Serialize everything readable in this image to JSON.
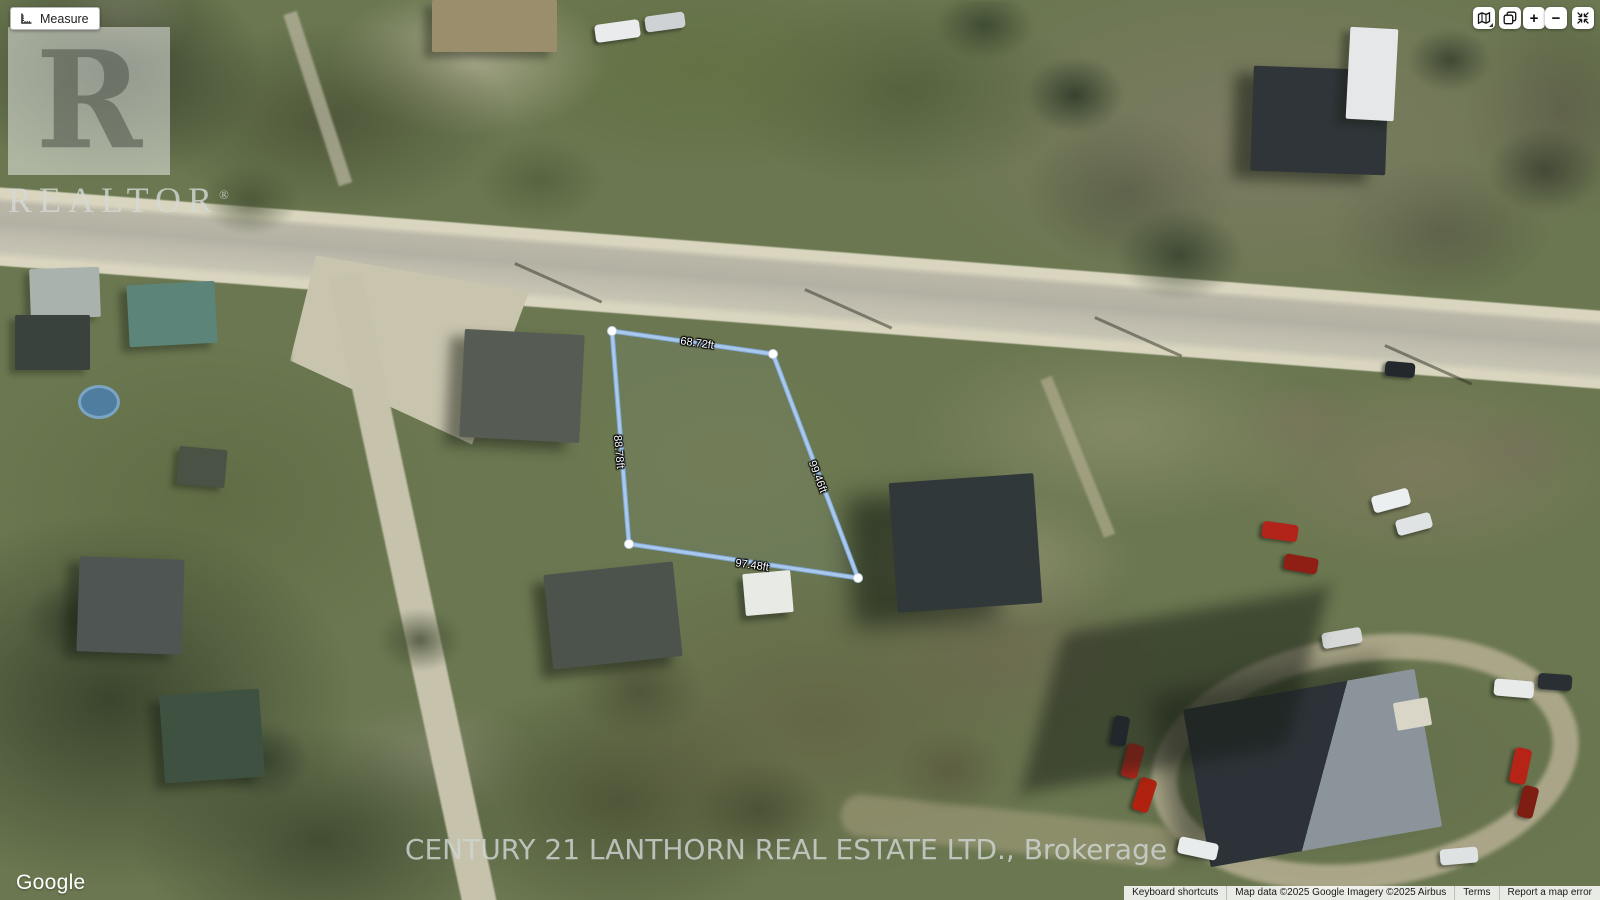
{
  "measure_tool": {
    "label": "Measure"
  },
  "map_controls": {
    "zoom_in": "+",
    "zoom_out": "−"
  },
  "watermarks": {
    "realtor_letter": "R",
    "realtor_text": "REALTOR",
    "registered": "®",
    "brokerage": "CENTURY 21 LANTHORN REAL ESTATE LTD., Brokerage",
    "google": "Google"
  },
  "measurement": {
    "unit": "ft",
    "line_color": "#a9c8ec",
    "vertex_color": "#ffffff",
    "vertices": [
      [
        612,
        331
      ],
      [
        773,
        354
      ],
      [
        858,
        578
      ],
      [
        629,
        544
      ]
    ],
    "labels": [
      {
        "text": "68.72ft",
        "x": 697,
        "y": 344,
        "rotation": 8
      },
      {
        "text": "99.46ft",
        "x": 817,
        "y": 477,
        "rotation": 69
      },
      {
        "text": "97.48ft",
        "x": 752,
        "y": 566,
        "rotation": 8
      },
      {
        "text": "88.78ft",
        "x": 618,
        "y": 452,
        "rotation": 85
      }
    ]
  },
  "attribution": {
    "keyboard_shortcuts": "Keyboard shortcuts",
    "map_data": "Map data ©2025 Google Imagery ©2025 Airbus",
    "terms": "Terms",
    "report_error": "Report a map error"
  }
}
